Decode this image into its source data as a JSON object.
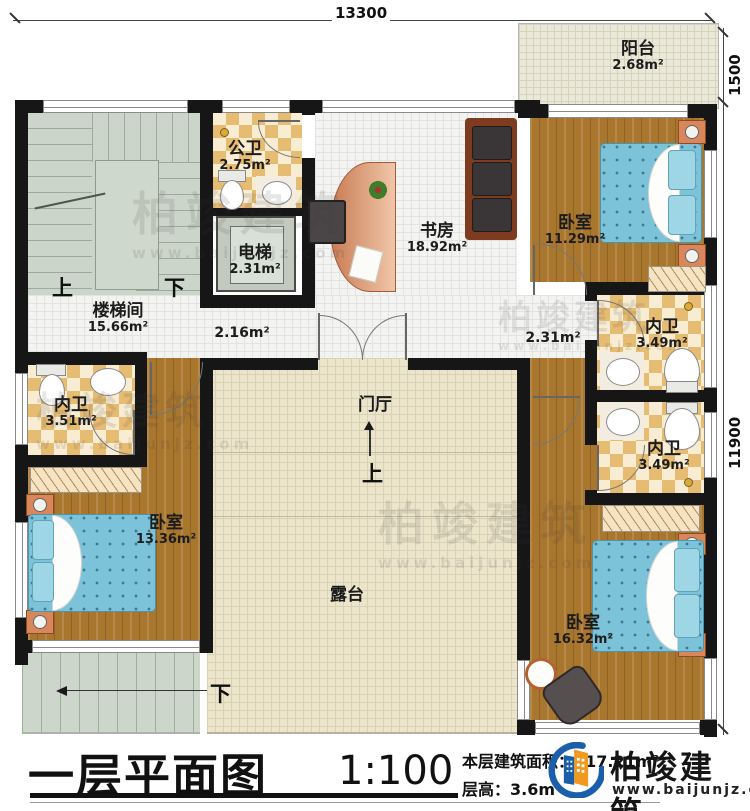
{
  "dims": {
    "top": "13300",
    "right_upper": "1500",
    "right_lower": "11900"
  },
  "rooms": {
    "balcony": {
      "name": "阳台",
      "area": "2.68m²"
    },
    "public_bath": {
      "name": "公卫",
      "area": "2.75m²"
    },
    "elevator": {
      "name": "电梯",
      "area": "2.31m²"
    },
    "study": {
      "name": "书房",
      "area": "18.92m²"
    },
    "bedroom_ne": {
      "name": "卧室",
      "area": "11.29m²"
    },
    "stairwell": {
      "name": "楼梯间",
      "area": "15.66m²"
    },
    "corridor": {
      "area": "2.16m²"
    },
    "hall_e": {
      "area": "2.31m²"
    },
    "bath_ne": {
      "name": "内卫",
      "area": "3.49m²"
    },
    "bath_e": {
      "name": "内卫",
      "area": "3.49m²"
    },
    "bath_w": {
      "name": "内卫",
      "area": "3.51m²"
    },
    "bedroom_sw": {
      "name": "卧室",
      "area": "13.36m²"
    },
    "bedroom_se": {
      "name": "卧室",
      "area": "16.32m²"
    },
    "foyer": {
      "name": "门厅"
    },
    "terrace": {
      "name": "露台"
    }
  },
  "stairs": {
    "up": "上",
    "down": "下",
    "foyer_up": "上",
    "outdoor_down": "下"
  },
  "title": {
    "name": "一层平面图",
    "scale": "1:100",
    "area_label": "本层建筑面积：",
    "area_value": "117.21m²",
    "height_label": "层高：",
    "height_value": "3.6m"
  },
  "logo": {
    "name": "柏竣建筑",
    "site": "www.baijunjz.com"
  },
  "watermark": {
    "text": "柏竣建筑",
    "site": "www.baijunjz.com"
  },
  "colors": {
    "wall": "#161616",
    "accent_blue": "#1b5ea9",
    "accent_orange": "#f1991f",
    "bed": "#7cc3d9"
  }
}
